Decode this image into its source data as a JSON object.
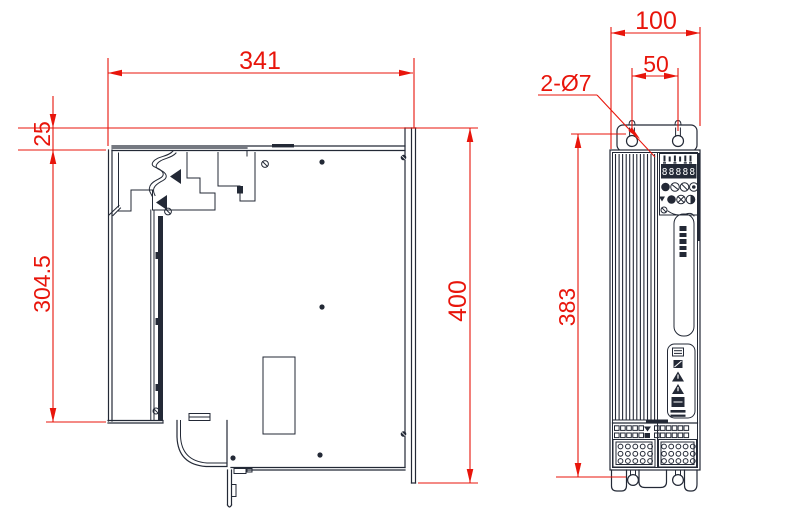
{
  "drawing": {
    "type": "engineering-dimension-drawing",
    "colors": {
      "dimension_red": "#e8150b",
      "line_ink": "#232936",
      "background": "#ffffff"
    },
    "side_view": {
      "dims": {
        "width": "341",
        "top_offset": "25",
        "front_height": "304.5",
        "overall_height": "400"
      }
    },
    "front_view": {
      "dims": {
        "width": "100",
        "hole_spacing": "50",
        "holes_note": "2-Ø7",
        "mount_height": "383"
      },
      "display_digits": "88888"
    }
  }
}
